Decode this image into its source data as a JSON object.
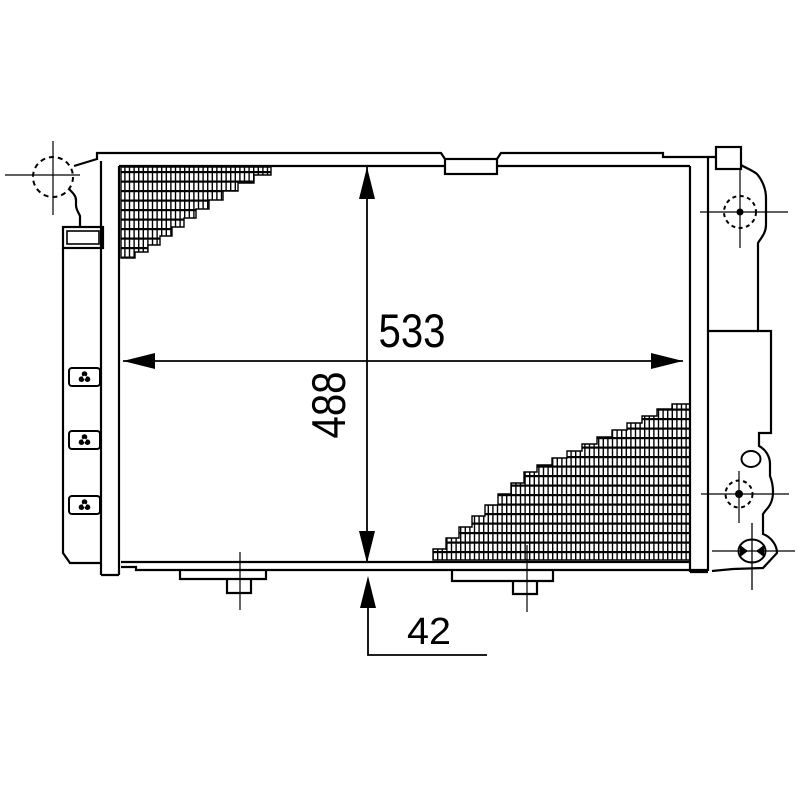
{
  "drawing": {
    "background_color": "#ffffff",
    "line_color": "#000000",
    "dimensions": {
      "width": "533",
      "height": "488",
      "bottom_offset": "42"
    },
    "symbols": {
      "port_marker": "dashed-circle-with-crosshair",
      "fastener_clip": "clover-clip-icon",
      "core_fill": "grid-crosshatch",
      "grommet": "ellipse-with-crosshair"
    }
  }
}
